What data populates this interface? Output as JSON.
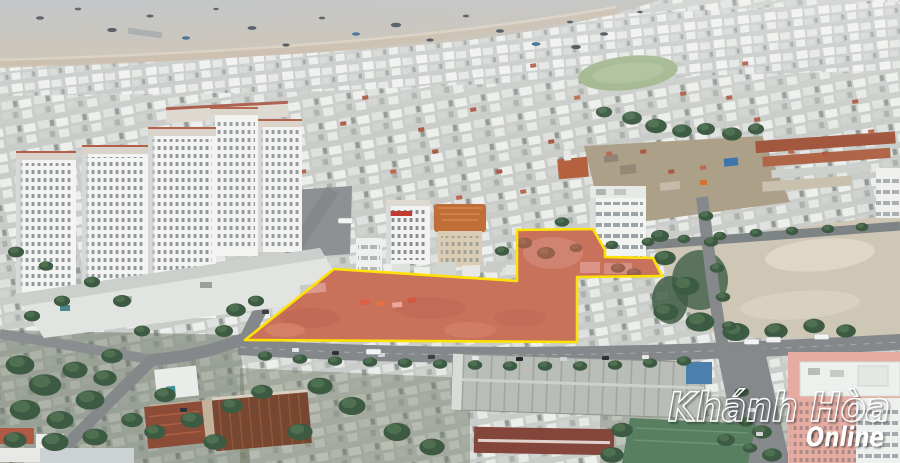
{
  "watermark": {
    "title": "Khánh Hòa",
    "subtitle": "Online"
  },
  "annotation": {
    "highlight_fill": "#f06555",
    "highlight_stroke": "#ffe205"
  }
}
